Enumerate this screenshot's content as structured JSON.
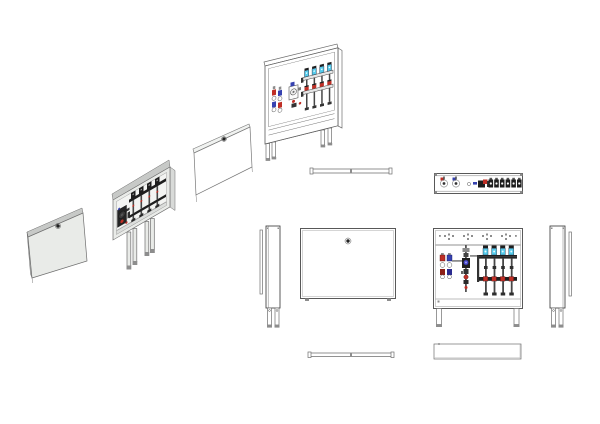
{
  "drawing": {
    "sheet_background": "#ffffff",
    "subject": "heating manifold cabinet, exploded isometric and orthographic views"
  },
  "colors": {
    "white": "#ffffff",
    "line": "#6e6e6e",
    "edge": "#3c3c3c",
    "fill_light": "#e9ebe8",
    "band": "#c7c9c7",
    "side": "#d8dad8",
    "inner": "#f3f4f2",
    "dark": "#1e1e1e",
    "pipe": "#474747",
    "gray": "#8d8d8d",
    "red": "#bf2f26",
    "red_dark": "#8c1f16",
    "blue": "#3642b0",
    "cyan": "#55cbec"
  },
  "components": {
    "circuits": 4,
    "actuators": 6,
    "rail_hole_groups": 4
  }
}
